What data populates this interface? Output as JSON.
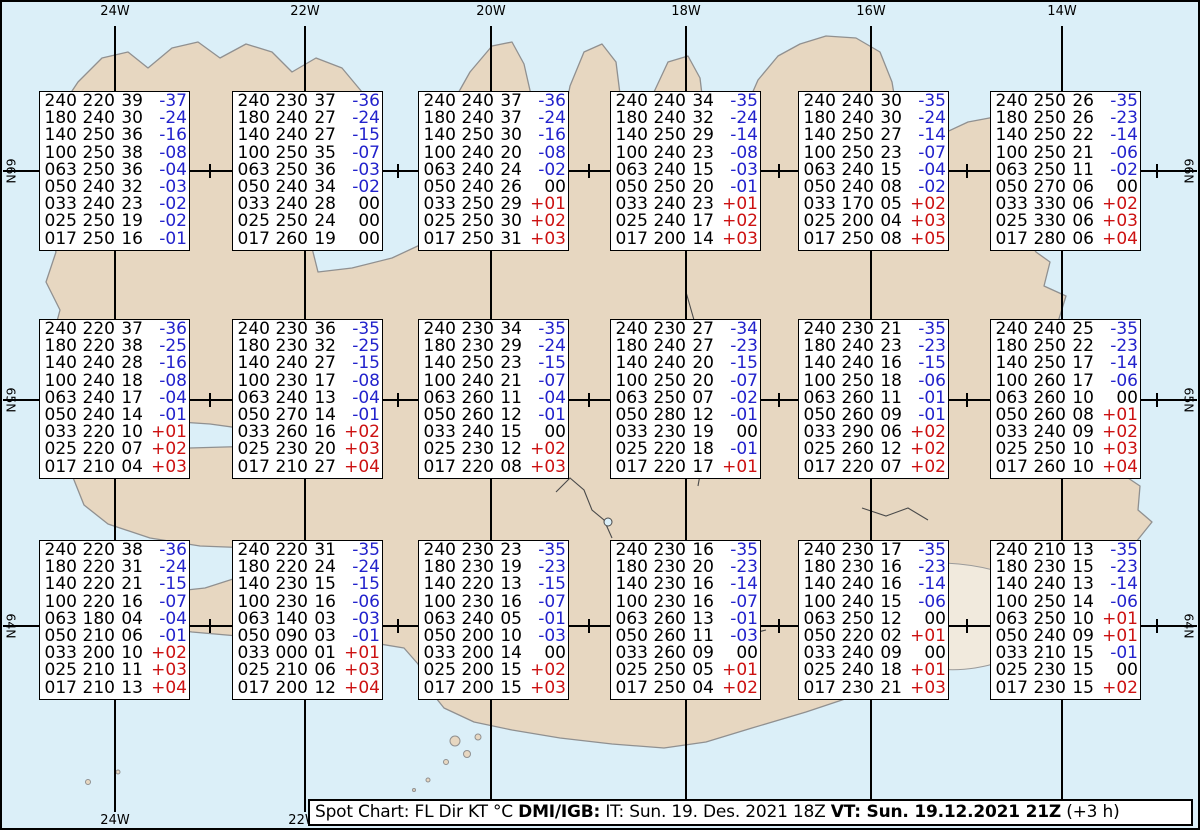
{
  "map": {
    "meridian_labels": [
      "24W",
      "22W",
      "20W",
      "18W",
      "16W",
      "14W"
    ],
    "bottom_meridian_labels": [
      "24W",
      "22W"
    ],
    "latitude_labels": [
      "66N",
      "65N",
      "64N"
    ],
    "colors": {
      "ocean": "#dbeff8",
      "land": "#e7d7c1",
      "glacier": "#f1eadd",
      "coastline": "#909090",
      "graticule": "#000000"
    }
  },
  "colors": {
    "temp_negative": "#2222cc",
    "temp_positive": "#cc1111",
    "temp_zero": "#000000"
  },
  "footer": {
    "segments": [
      {
        "text": "Spot Chart: FL Dir KT °C ",
        "bold": false
      },
      {
        "text": "DMI/IGB:",
        "bold": true
      },
      {
        "text": " IT: Sun. 19. Des. 2021 18Z ",
        "bold": false
      },
      {
        "text": "VT: Sun. 19.12.2021 21Z",
        "bold": true
      },
      {
        "text": " (+3 h)",
        "bold": false
      }
    ]
  },
  "spot_boxes": [
    {
      "row": 0,
      "col": 0,
      "rows": [
        [
          "240",
          "220",
          "39",
          "-37"
        ],
        [
          "180",
          "240",
          "30",
          "-24"
        ],
        [
          "140",
          "250",
          "36",
          "-16"
        ],
        [
          "100",
          "250",
          "38",
          "-08"
        ],
        [
          "063",
          "250",
          "36",
          "-04"
        ],
        [
          "050",
          "240",
          "32",
          "-03"
        ],
        [
          "033",
          "240",
          "23",
          "-02"
        ],
        [
          "025",
          "250",
          "19",
          "-02"
        ],
        [
          "017",
          "250",
          "16",
          "-01"
        ]
      ]
    },
    {
      "row": 0,
      "col": 1,
      "rows": [
        [
          "240",
          "230",
          "37",
          "-36"
        ],
        [
          "180",
          "240",
          "27",
          "-24"
        ],
        [
          "140",
          "240",
          "27",
          "-15"
        ],
        [
          "100",
          "250",
          "35",
          "-07"
        ],
        [
          "063",
          "250",
          "36",
          "-03"
        ],
        [
          "050",
          "240",
          "34",
          "-02"
        ],
        [
          "033",
          "240",
          "28",
          "00"
        ],
        [
          "025",
          "250",
          "24",
          "00"
        ],
        [
          "017",
          "260",
          "19",
          "00"
        ]
      ]
    },
    {
      "row": 0,
      "col": 2,
      "rows": [
        [
          "240",
          "240",
          "37",
          "-36"
        ],
        [
          "180",
          "240",
          "37",
          "-24"
        ],
        [
          "140",
          "250",
          "30",
          "-16"
        ],
        [
          "100",
          "240",
          "20",
          "-08"
        ],
        [
          "063",
          "240",
          "24",
          "-02"
        ],
        [
          "050",
          "240",
          "26",
          "00"
        ],
        [
          "033",
          "250",
          "29",
          "+01"
        ],
        [
          "025",
          "250",
          "30",
          "+02"
        ],
        [
          "017",
          "250",
          "31",
          "+03"
        ]
      ]
    },
    {
      "row": 0,
      "col": 3,
      "rows": [
        [
          "240",
          "240",
          "34",
          "-35"
        ],
        [
          "180",
          "240",
          "32",
          "-24"
        ],
        [
          "140",
          "250",
          "29",
          "-14"
        ],
        [
          "100",
          "240",
          "23",
          "-08"
        ],
        [
          "063",
          "240",
          "15",
          "-03"
        ],
        [
          "050",
          "250",
          "20",
          "-01"
        ],
        [
          "033",
          "240",
          "23",
          "+01"
        ],
        [
          "025",
          "240",
          "17",
          "+02"
        ],
        [
          "017",
          "200",
          "14",
          "+03"
        ]
      ]
    },
    {
      "row": 0,
      "col": 4,
      "rows": [
        [
          "240",
          "240",
          "30",
          "-35"
        ],
        [
          "180",
          "240",
          "30",
          "-24"
        ],
        [
          "140",
          "250",
          "27",
          "-14"
        ],
        [
          "100",
          "250",
          "23",
          "-07"
        ],
        [
          "063",
          "240",
          "15",
          "-04"
        ],
        [
          "050",
          "240",
          "08",
          "-02"
        ],
        [
          "033",
          "170",
          "05",
          "+02"
        ],
        [
          "025",
          "200",
          "04",
          "+03"
        ],
        [
          "017",
          "250",
          "08",
          "+05"
        ]
      ]
    },
    {
      "row": 0,
      "col": 5,
      "rows": [
        [
          "240",
          "250",
          "26",
          "-35"
        ],
        [
          "180",
          "250",
          "26",
          "-23"
        ],
        [
          "140",
          "250",
          "22",
          "-14"
        ],
        [
          "100",
          "250",
          "21",
          "-06"
        ],
        [
          "063",
          "250",
          "11",
          "-02"
        ],
        [
          "050",
          "270",
          "06",
          "00"
        ],
        [
          "033",
          "330",
          "06",
          "+02"
        ],
        [
          "025",
          "330",
          "06",
          "+03"
        ],
        [
          "017",
          "280",
          "06",
          "+04"
        ]
      ]
    },
    {
      "row": 1,
      "col": 0,
      "rows": [
        [
          "240",
          "220",
          "37",
          "-36"
        ],
        [
          "180",
          "220",
          "38",
          "-25"
        ],
        [
          "140",
          "240",
          "28",
          "-16"
        ],
        [
          "100",
          "240",
          "18",
          "-08"
        ],
        [
          "063",
          "240",
          "17",
          "-04"
        ],
        [
          "050",
          "240",
          "14",
          "-01"
        ],
        [
          "033",
          "220",
          "10",
          "+01"
        ],
        [
          "025",
          "220",
          "07",
          "+02"
        ],
        [
          "017",
          "210",
          "04",
          "+03"
        ]
      ]
    },
    {
      "row": 1,
      "col": 1,
      "rows": [
        [
          "240",
          "230",
          "36",
          "-35"
        ],
        [
          "180",
          "230",
          "32",
          "-25"
        ],
        [
          "140",
          "240",
          "27",
          "-15"
        ],
        [
          "100",
          "230",
          "17",
          "-08"
        ],
        [
          "063",
          "240",
          "13",
          "-04"
        ],
        [
          "050",
          "270",
          "14",
          "-01"
        ],
        [
          "033",
          "260",
          "16",
          "+02"
        ],
        [
          "025",
          "230",
          "20",
          "+03"
        ],
        [
          "017",
          "210",
          "27",
          "+04"
        ]
      ]
    },
    {
      "row": 1,
      "col": 2,
      "rows": [
        [
          "240",
          "230",
          "34",
          "-35"
        ],
        [
          "180",
          "230",
          "29",
          "-24"
        ],
        [
          "140",
          "250",
          "23",
          "-15"
        ],
        [
          "100",
          "240",
          "21",
          "-07"
        ],
        [
          "063",
          "260",
          "11",
          "-04"
        ],
        [
          "050",
          "260",
          "12",
          "-01"
        ],
        [
          "033",
          "240",
          "15",
          "00"
        ],
        [
          "025",
          "230",
          "12",
          "+02"
        ],
        [
          "017",
          "220",
          "08",
          "+03"
        ]
      ]
    },
    {
      "row": 1,
      "col": 3,
      "rows": [
        [
          "240",
          "230",
          "27",
          "-34"
        ],
        [
          "180",
          "240",
          "27",
          "-23"
        ],
        [
          "140",
          "240",
          "20",
          "-15"
        ],
        [
          "100",
          "250",
          "20",
          "-07"
        ],
        [
          "063",
          "250",
          "07",
          "-02"
        ],
        [
          "050",
          "280",
          "12",
          "-01"
        ],
        [
          "033",
          "230",
          "19",
          "00"
        ],
        [
          "025",
          "220",
          "18",
          "-01"
        ],
        [
          "017",
          "220",
          "17",
          "+01"
        ]
      ]
    },
    {
      "row": 1,
      "col": 4,
      "rows": [
        [
          "240",
          "230",
          "21",
          "-35"
        ],
        [
          "180",
          "240",
          "23",
          "-23"
        ],
        [
          "140",
          "240",
          "16",
          "-15"
        ],
        [
          "100",
          "250",
          "18",
          "-06"
        ],
        [
          "063",
          "260",
          "11",
          "-01"
        ],
        [
          "050",
          "260",
          "09",
          "-01"
        ],
        [
          "033",
          "290",
          "06",
          "+02"
        ],
        [
          "025",
          "260",
          "12",
          "+02"
        ],
        [
          "017",
          "220",
          "07",
          "+02"
        ]
      ]
    },
    {
      "row": 1,
      "col": 5,
      "rows": [
        [
          "240",
          "240",
          "25",
          "-35"
        ],
        [
          "180",
          "250",
          "22",
          "-23"
        ],
        [
          "140",
          "250",
          "17",
          "-14"
        ],
        [
          "100",
          "260",
          "17",
          "-06"
        ],
        [
          "063",
          "260",
          "10",
          "00"
        ],
        [
          "050",
          "260",
          "08",
          "+01"
        ],
        [
          "033",
          "240",
          "09",
          "+02"
        ],
        [
          "025",
          "250",
          "10",
          "+03"
        ],
        [
          "017",
          "260",
          "10",
          "+04"
        ]
      ]
    },
    {
      "row": 2,
      "col": 0,
      "rows": [
        [
          "240",
          "220",
          "38",
          "-36"
        ],
        [
          "180",
          "220",
          "31",
          "-24"
        ],
        [
          "140",
          "220",
          "21",
          "-15"
        ],
        [
          "100",
          "220",
          "16",
          "-07"
        ],
        [
          "063",
          "180",
          "04",
          "-04"
        ],
        [
          "050",
          "210",
          "06",
          "-01"
        ],
        [
          "033",
          "200",
          "10",
          "+02"
        ],
        [
          "025",
          "210",
          "11",
          "+03"
        ],
        [
          "017",
          "210",
          "13",
          "+04"
        ]
      ]
    },
    {
      "row": 2,
      "col": 1,
      "rows": [
        [
          "240",
          "220",
          "31",
          "-35"
        ],
        [
          "180",
          "220",
          "24",
          "-24"
        ],
        [
          "140",
          "230",
          "15",
          "-15"
        ],
        [
          "100",
          "230",
          "16",
          "-06"
        ],
        [
          "063",
          "140",
          "03",
          "-03"
        ],
        [
          "050",
          "090",
          "03",
          "-01"
        ],
        [
          "033",
          "000",
          "01",
          "+01"
        ],
        [
          "025",
          "210",
          "06",
          "+03"
        ],
        [
          "017",
          "200",
          "12",
          "+04"
        ]
      ]
    },
    {
      "row": 2,
      "col": 2,
      "rows": [
        [
          "240",
          "230",
          "23",
          "-35"
        ],
        [
          "180",
          "230",
          "19",
          "-23"
        ],
        [
          "140",
          "220",
          "13",
          "-15"
        ],
        [
          "100",
          "230",
          "16",
          "-07"
        ],
        [
          "063",
          "240",
          "05",
          "-01"
        ],
        [
          "050",
          "200",
          "10",
          "-03"
        ],
        [
          "033",
          "200",
          "14",
          "00"
        ],
        [
          "025",
          "200",
          "15",
          "+02"
        ],
        [
          "017",
          "200",
          "15",
          "+03"
        ]
      ]
    },
    {
      "row": 2,
      "col": 3,
      "rows": [
        [
          "240",
          "230",
          "16",
          "-35"
        ],
        [
          "180",
          "230",
          "20",
          "-23"
        ],
        [
          "140",
          "230",
          "16",
          "-14"
        ],
        [
          "100",
          "230",
          "16",
          "-07"
        ],
        [
          "063",
          "260",
          "13",
          "-01"
        ],
        [
          "050",
          "260",
          "11",
          "-03"
        ],
        [
          "033",
          "260",
          "09",
          "00"
        ],
        [
          "025",
          "250",
          "05",
          "+01"
        ],
        [
          "017",
          "250",
          "04",
          "+02"
        ]
      ]
    },
    {
      "row": 2,
      "col": 4,
      "rows": [
        [
          "240",
          "230",
          "17",
          "-35"
        ],
        [
          "180",
          "230",
          "16",
          "-23"
        ],
        [
          "140",
          "240",
          "16",
          "-14"
        ],
        [
          "100",
          "240",
          "15",
          "-06"
        ],
        [
          "063",
          "250",
          "12",
          "00"
        ],
        [
          "050",
          "220",
          "02",
          "+01"
        ],
        [
          "033",
          "240",
          "09",
          "00"
        ],
        [
          "025",
          "240",
          "18",
          "+01"
        ],
        [
          "017",
          "230",
          "21",
          "+03"
        ]
      ]
    },
    {
      "row": 2,
      "col": 5,
      "rows": [
        [
          "240",
          "210",
          "13",
          "-35"
        ],
        [
          "180",
          "230",
          "15",
          "-23"
        ],
        [
          "140",
          "240",
          "13",
          "-14"
        ],
        [
          "100",
          "250",
          "14",
          "-06"
        ],
        [
          "063",
          "250",
          "10",
          "+01"
        ],
        [
          "050",
          "240",
          "09",
          "+01"
        ],
        [
          "033",
          "210",
          "15",
          "-01"
        ],
        [
          "025",
          "230",
          "15",
          "00"
        ],
        [
          "017",
          "230",
          "15",
          "+02"
        ]
      ]
    }
  ]
}
